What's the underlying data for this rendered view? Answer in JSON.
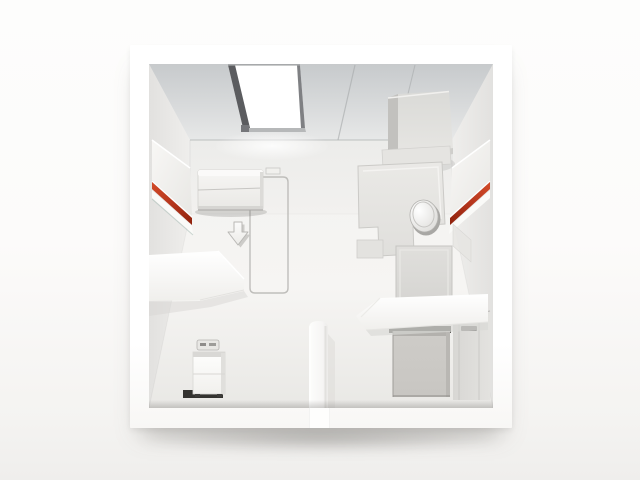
{
  "scene": {
    "type": "3d-room-cutaway-render",
    "view": "top-down dollhouse view of a compact cabin room, no text or labels",
    "objects": [
      {
        "id": "room-frame",
        "label": "white cube room shell"
      },
      {
        "id": "ceiling",
        "label": "gray ceiling band with panel seams"
      },
      {
        "id": "skylight",
        "label": "bright skylight opening with dark frame"
      },
      {
        "id": "ceiling-unit",
        "label": "box unit mounted at ceiling corner"
      },
      {
        "id": "left-wall-panel",
        "label": "wall panel with red accent stripe"
      },
      {
        "id": "right-wall-panel",
        "label": "wall panel with red accent stripe"
      },
      {
        "id": "folded-wall-bed",
        "label": "folded wall-bed storage unit"
      },
      {
        "id": "fold-out-outline",
        "label": "rounded outline marking fold-out footprint on floor"
      },
      {
        "id": "floor-arrow",
        "label": "downward deployment arrow on floor"
      },
      {
        "id": "left-partition",
        "label": "white partition shelf wall (left room)"
      },
      {
        "id": "drawer-cabinet",
        "label": "small two-drawer cabinet with tray on top"
      },
      {
        "id": "center-partition",
        "label": "short partition wall stub at bottom center"
      },
      {
        "id": "right-partition",
        "label": "white partition shelf wall (right room)"
      },
      {
        "id": "toilet-platform",
        "label": "beveled bathroom platform"
      },
      {
        "id": "toilet",
        "label": "toilet with closed oval lid and flush knob"
      },
      {
        "id": "vanity-box",
        "label": "raised vanity / shower box"
      },
      {
        "id": "storage-box",
        "label": "gray storage box at bottom right"
      },
      {
        "id": "entry-door",
        "label": "entry door with horizontal handle on right wall"
      }
    ]
  },
  "colors": {
    "background": "#fbfbfa",
    "frame_white": "#ffffff",
    "ceiling_gray": "#d5d7d8",
    "wall_gray": "#ebeae8",
    "floor_gray": "#f3f2f0",
    "accent_red": "#b5361d",
    "accent_red_dark": "#8f220d",
    "accent_red_light": "#d24a28",
    "box_gray": "#c8c6c2",
    "line_gray": "#b9b8b5",
    "skylight_frame": "#5b5c5f",
    "skylight_white": "#ffffff"
  }
}
